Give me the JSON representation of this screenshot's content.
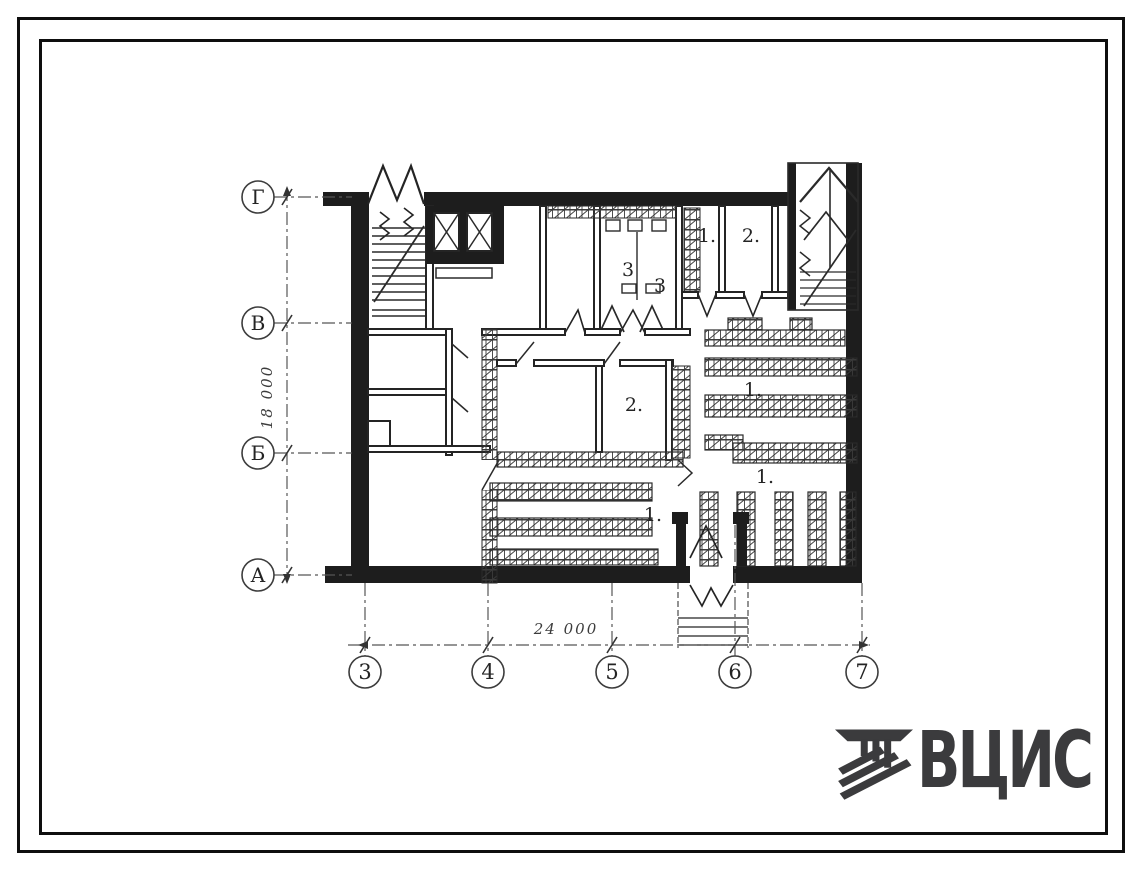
{
  "document": {
    "kind": "scanned architectural floor plan",
    "paper_color": "#ffffff",
    "ink_color": "#1d1d1d"
  },
  "plan": {
    "row_axes": [
      {
        "label": "Г"
      },
      {
        "label": "В"
      },
      {
        "label": "Б"
      },
      {
        "label": "А"
      }
    ],
    "col_axes": [
      {
        "label": "3"
      },
      {
        "label": "4"
      },
      {
        "label": "5"
      },
      {
        "label": "6"
      },
      {
        "label": "7"
      }
    ],
    "dim_vertical": "18 000",
    "dim_horizontal": "24 000",
    "room_labels": [
      {
        "text": "3"
      },
      {
        "text": "3"
      },
      {
        "text": "1."
      },
      {
        "text": "2."
      },
      {
        "text": "2."
      },
      {
        "text": "1."
      },
      {
        "text": "1."
      },
      {
        "text": "1."
      }
    ]
  },
  "logo": {
    "text": "ВЦИС",
    "color": "#3b3b3d",
    "icon": "vcis-emblem-icon"
  }
}
